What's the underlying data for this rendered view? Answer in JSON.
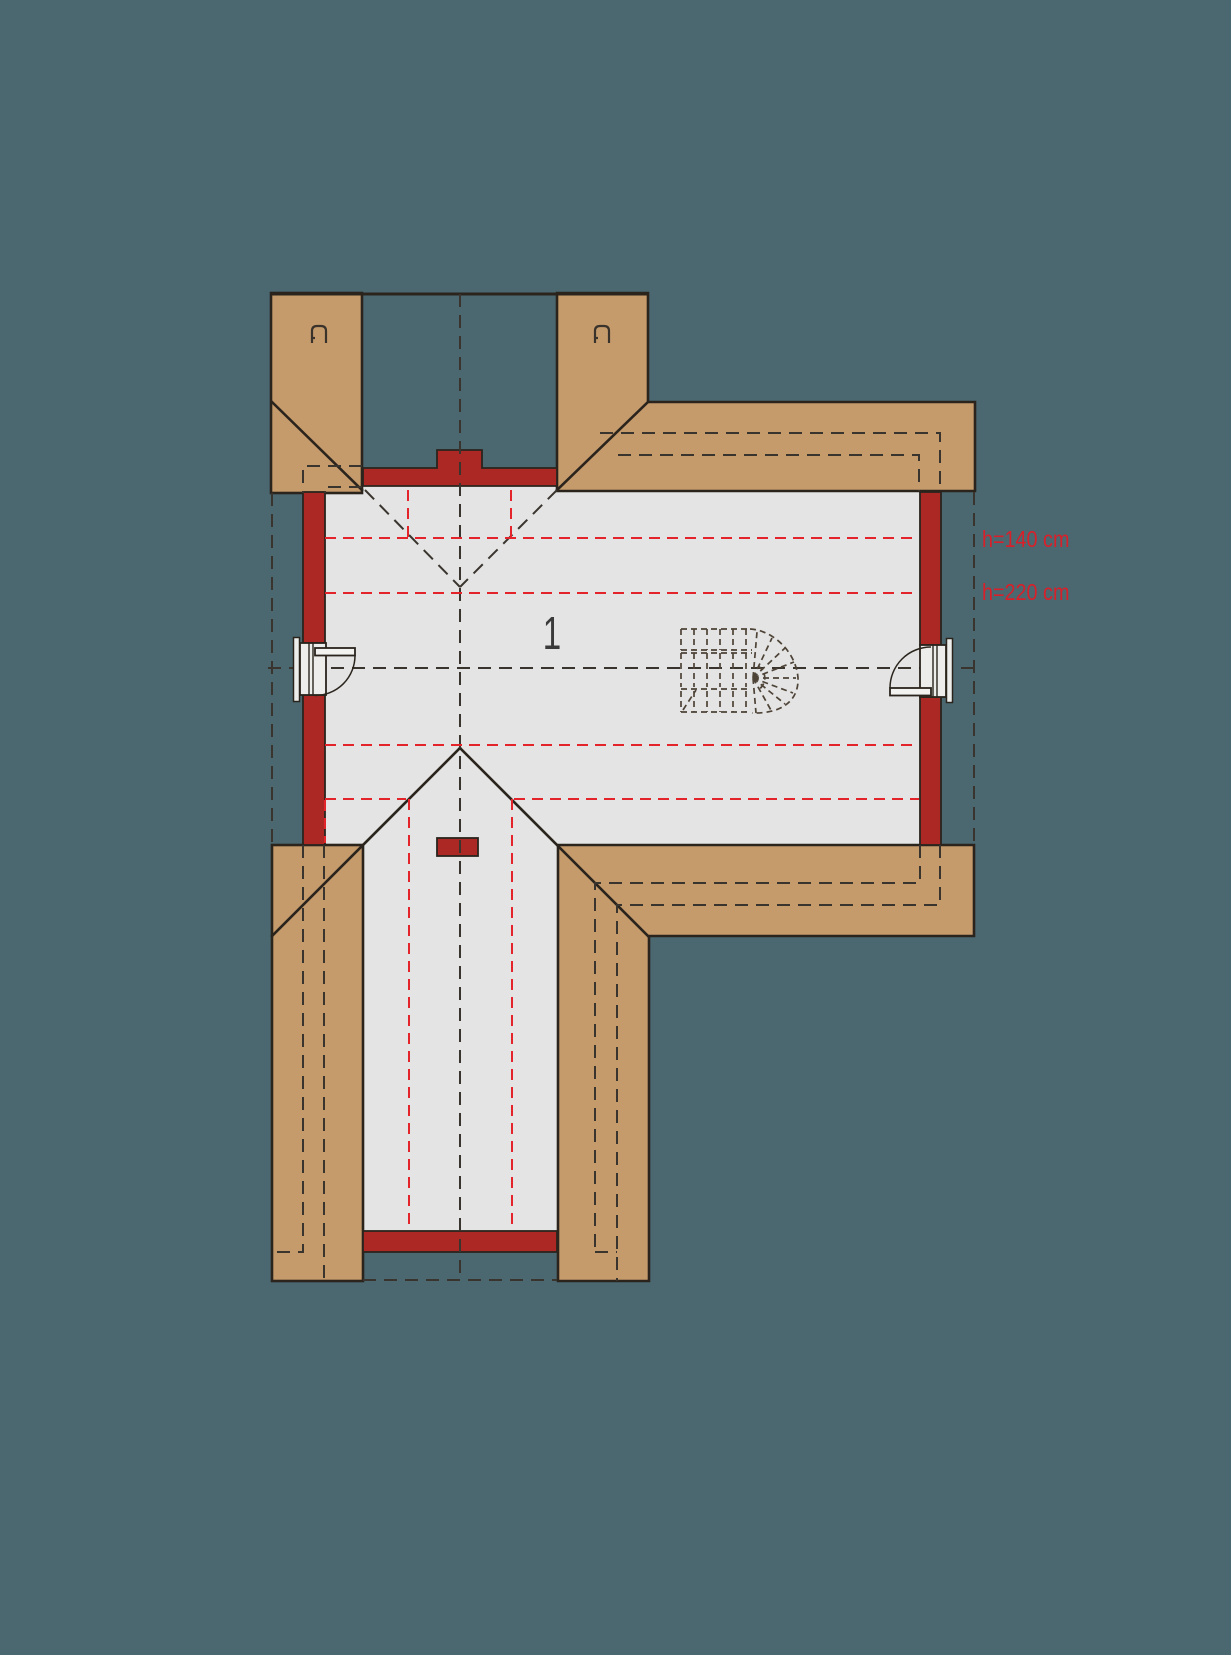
{
  "plan": {
    "title": "attic-floor-plan",
    "room_label": "1",
    "height_labels": {
      "h140": "h=140 cm",
      "h220": "h=220 cm"
    },
    "icons": {
      "chimney_vent_left": "chimney-vent",
      "chimney_vent_right": "chimney-vent"
    },
    "colors": {
      "background": "#4b6871",
      "roof": "#c69b6c",
      "outline": "#2a241d",
      "wall": "#ab2824",
      "floor": "#e3e4e3",
      "dash_dark": "#3a342e",
      "dash_red": "#e3242b",
      "stair": "#4e4337",
      "vent": "#3a332c",
      "label_red": "#d8202a",
      "label_dark": "#3a3a3a"
    }
  }
}
